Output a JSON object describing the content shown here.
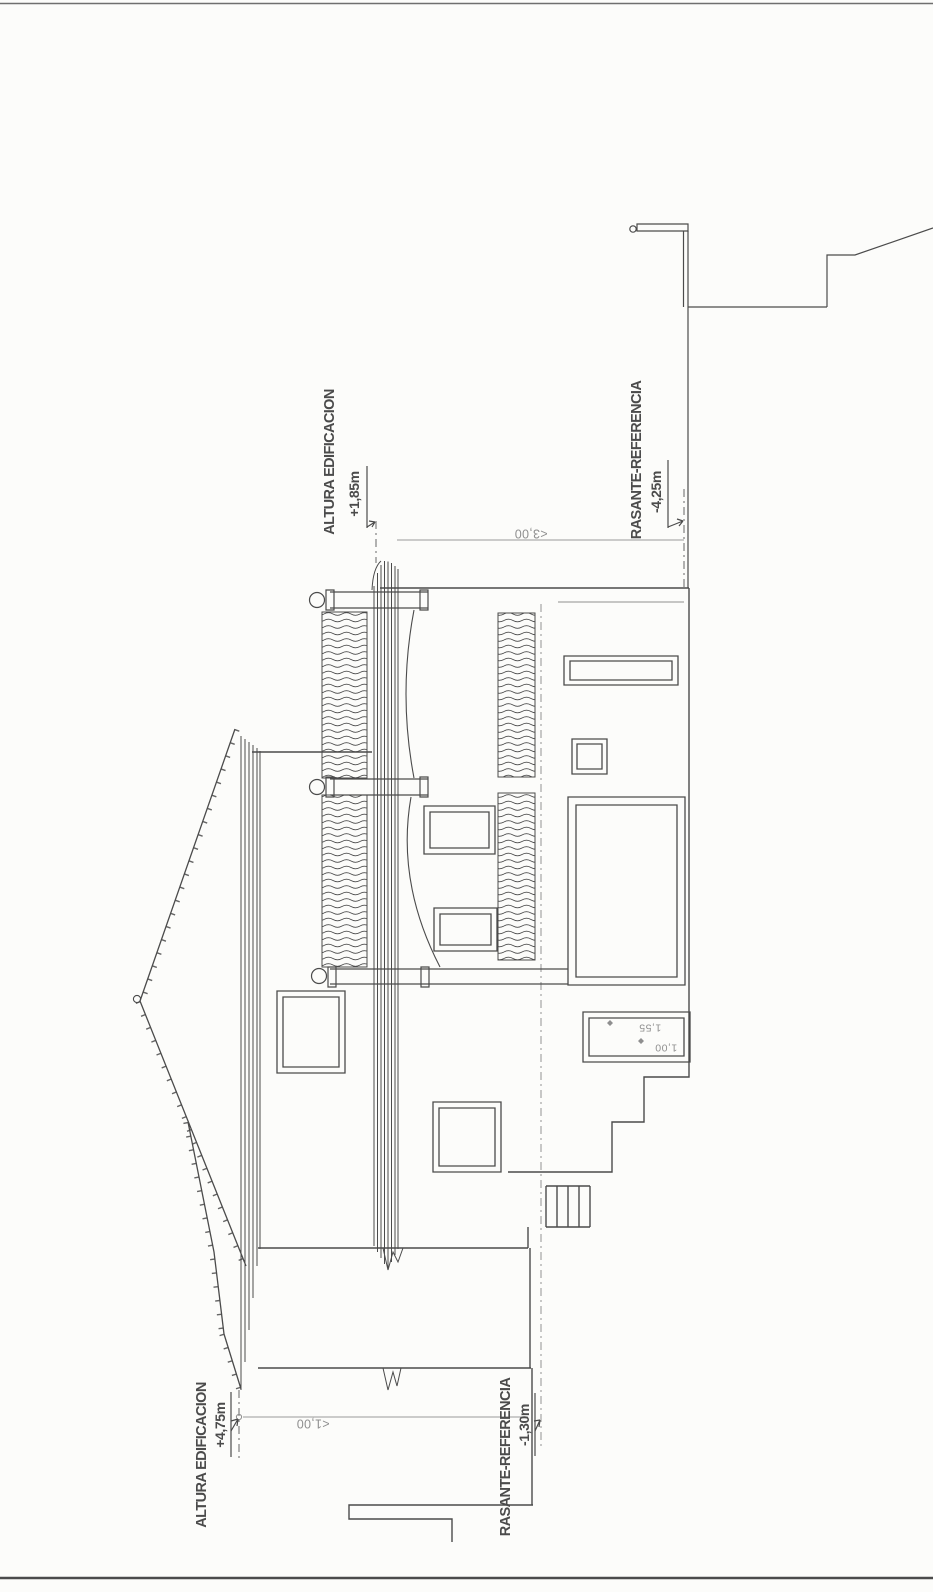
{
  "sheet": {
    "labels": {
      "upper_height_label": "ALTURA EDIFICACION",
      "upper_height_value": "+1,85m",
      "upper_grade_label": "RASANTE-REFERENCIA",
      "upper_grade_value": "-4,25m",
      "lower_height_label": "ALTURA EDIFICACION",
      "lower_height_value": "+4,75m",
      "lower_grade_label": "RASANTE-REFERENCIA",
      "lower_grade_value": "-1,30m"
    },
    "dimensions": {
      "bay_width": "<3,00",
      "eave_offset": "<1,00",
      "pool_dim_upper": "1,55",
      "pool_dim_lower": "1,00"
    },
    "colors": {
      "ink": "#4b4b4b",
      "ink_light": "#8f8f8f",
      "paper": "#fcfcfa"
    }
  }
}
